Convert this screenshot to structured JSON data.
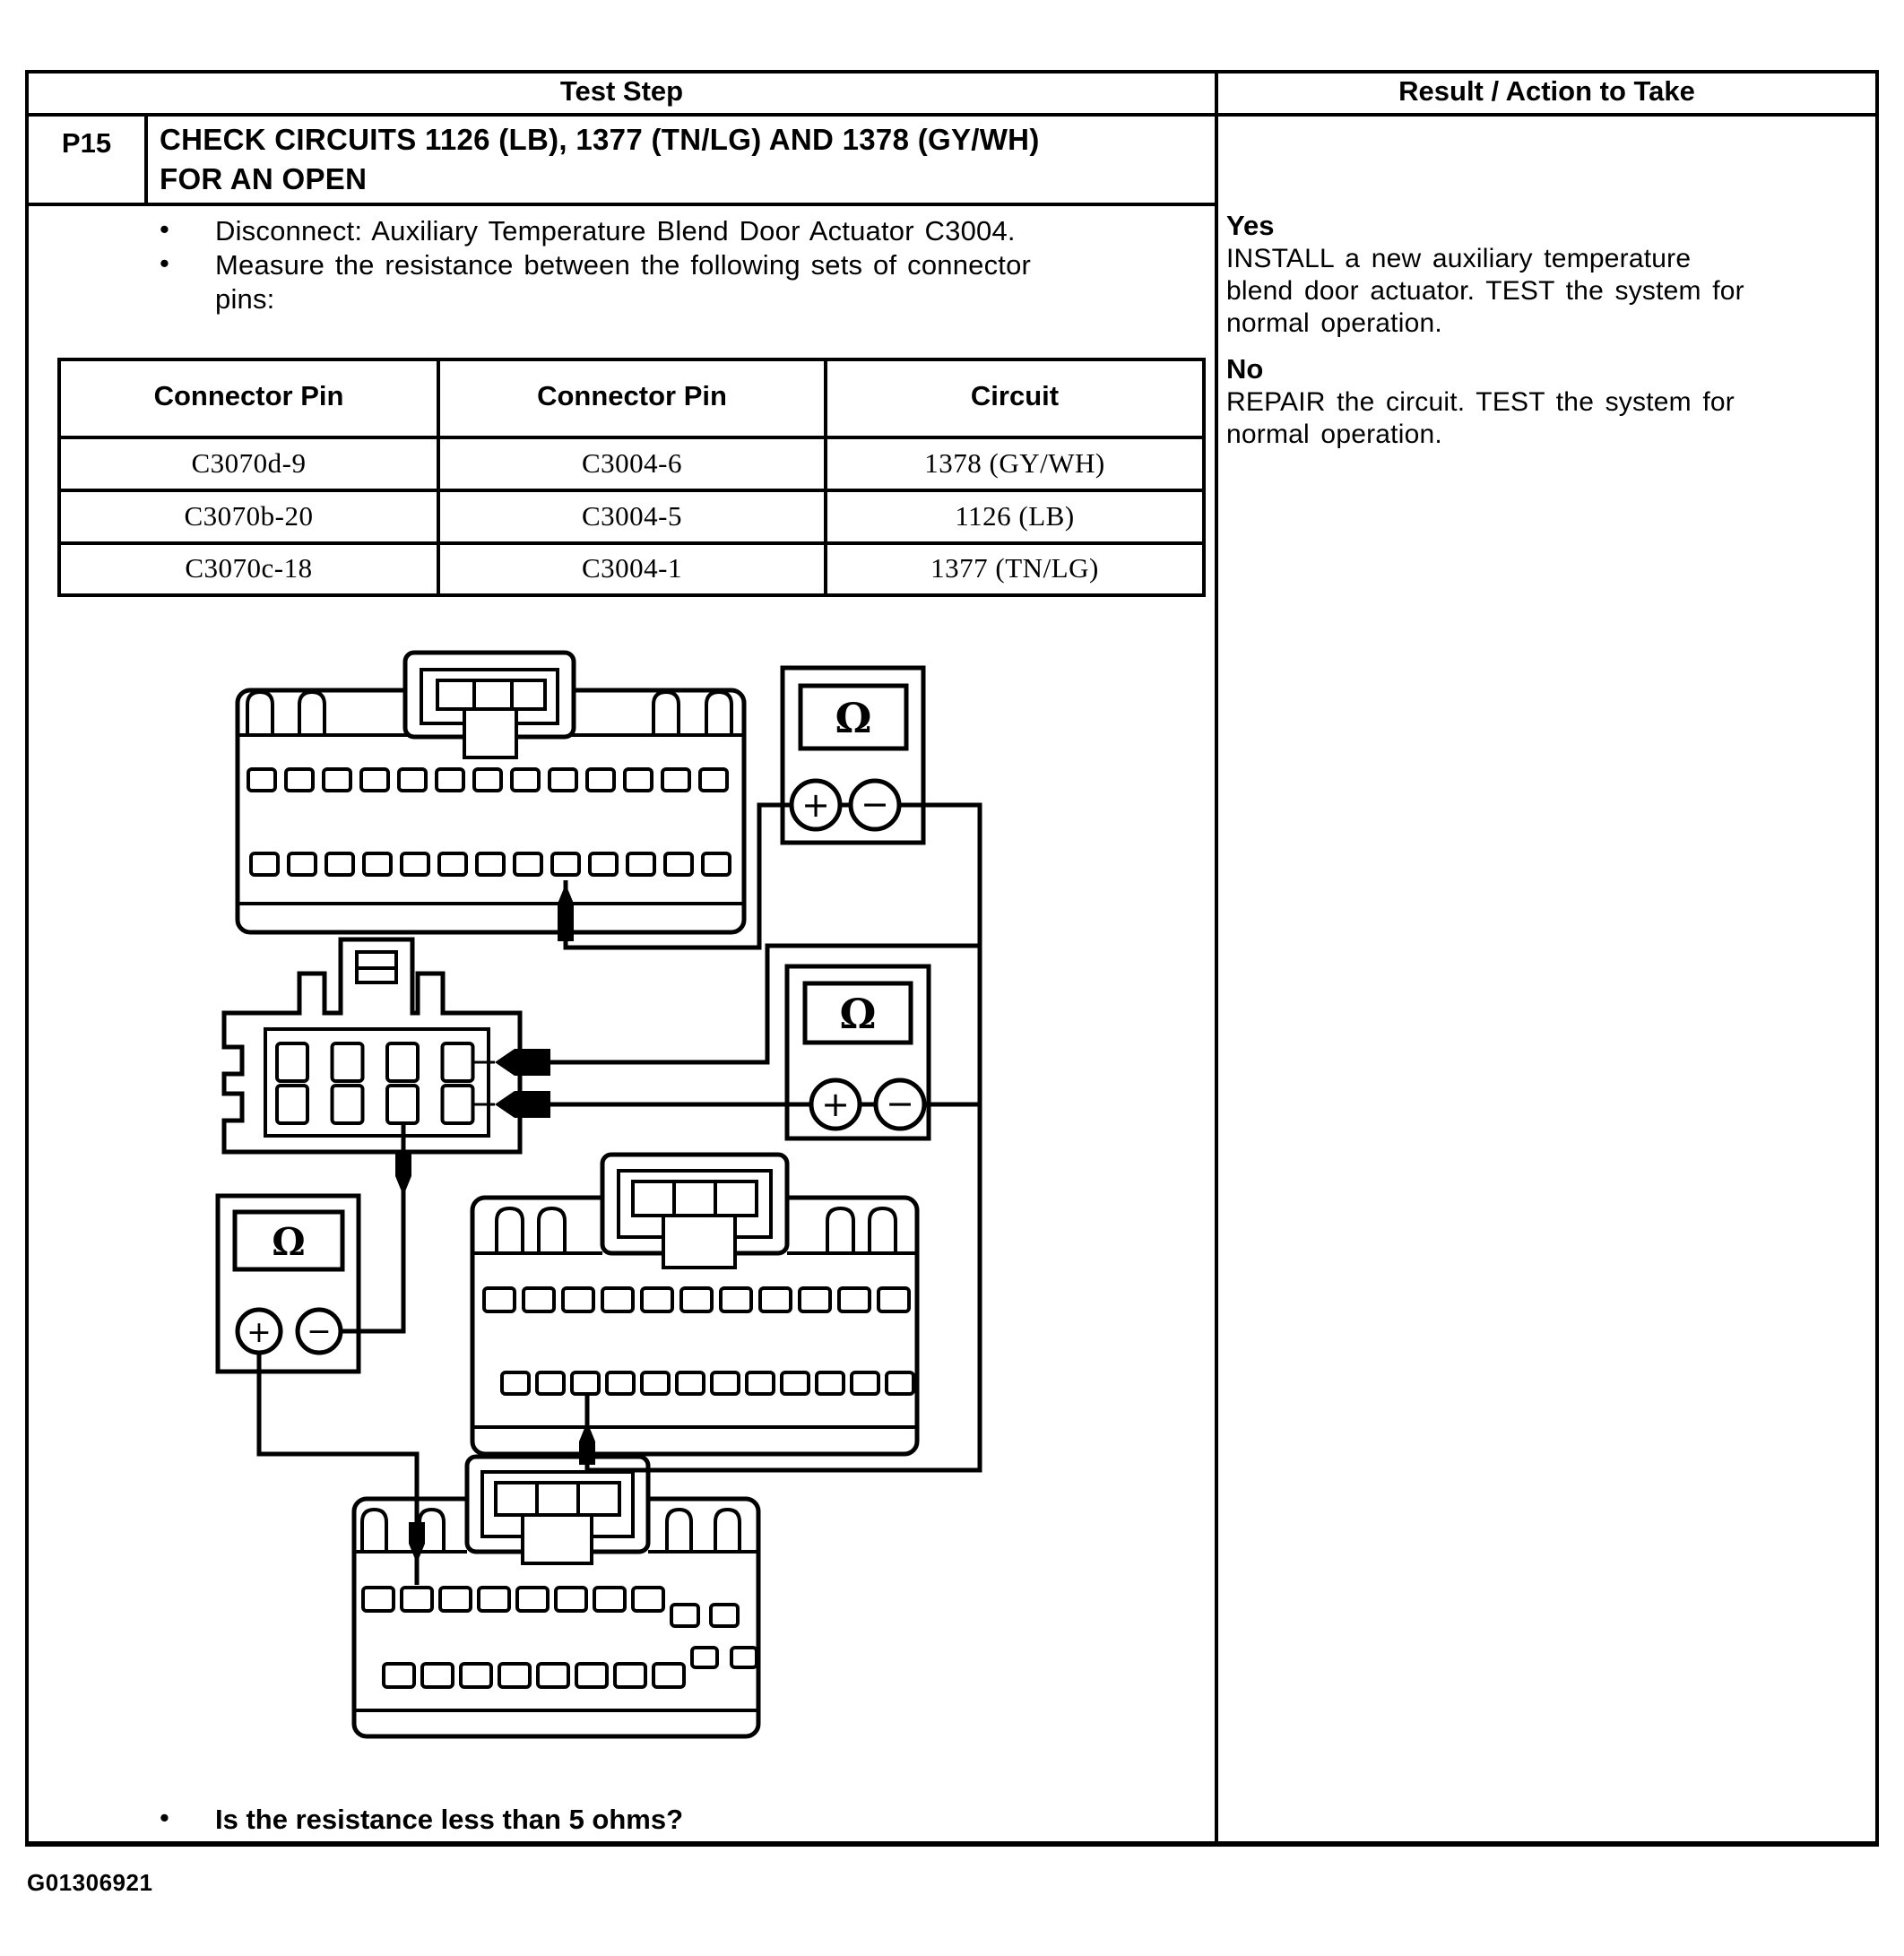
{
  "header": {
    "test_step": "Test Step",
    "result": "Result / Action to Take"
  },
  "step": {
    "id": "P15",
    "title_line1": "CHECK CIRCUITS 1126 (LB), 1377 (TN/LG) AND 1378 (GY/WH)",
    "title_line2": "FOR AN OPEN"
  },
  "bullets": {
    "dot": "•",
    "b1": "Disconnect:  Auxiliary Temperature Blend Door Actuator C3004.",
    "b2_line1": "Measure the resistance between the following sets of connector",
    "b2_line2": "pins:",
    "question": "Is the resistance less than 5 ohms?"
  },
  "pin_table": {
    "headers": [
      "Connector Pin",
      "Connector Pin",
      "Circuit"
    ],
    "rows": [
      [
        "C3070d-9",
        "C3004-6",
        "1378 (GY/WH)"
      ],
      [
        "C3070b-20",
        "C3004-5",
        "1126 (LB)"
      ],
      [
        "C3070c-18",
        "C3004-1",
        "1377 (TN/LG)"
      ]
    ]
  },
  "result": {
    "yes_label": "Yes",
    "yes_line1": "INSTALL a new auxiliary temperature",
    "yes_line2": "blend door actuator. TEST the system for",
    "yes_line3": "normal operation.",
    "no_label": "No",
    "no_line1": "REPAIR the circuit. TEST the system for",
    "no_line2": "normal operation."
  },
  "diagram": {
    "ohm": "Ω",
    "plus": "+",
    "minus": "−"
  },
  "footer": {
    "figure_id": "G01306921"
  },
  "colors": {
    "ink": "#000000",
    "paper": "#ffffff"
  }
}
